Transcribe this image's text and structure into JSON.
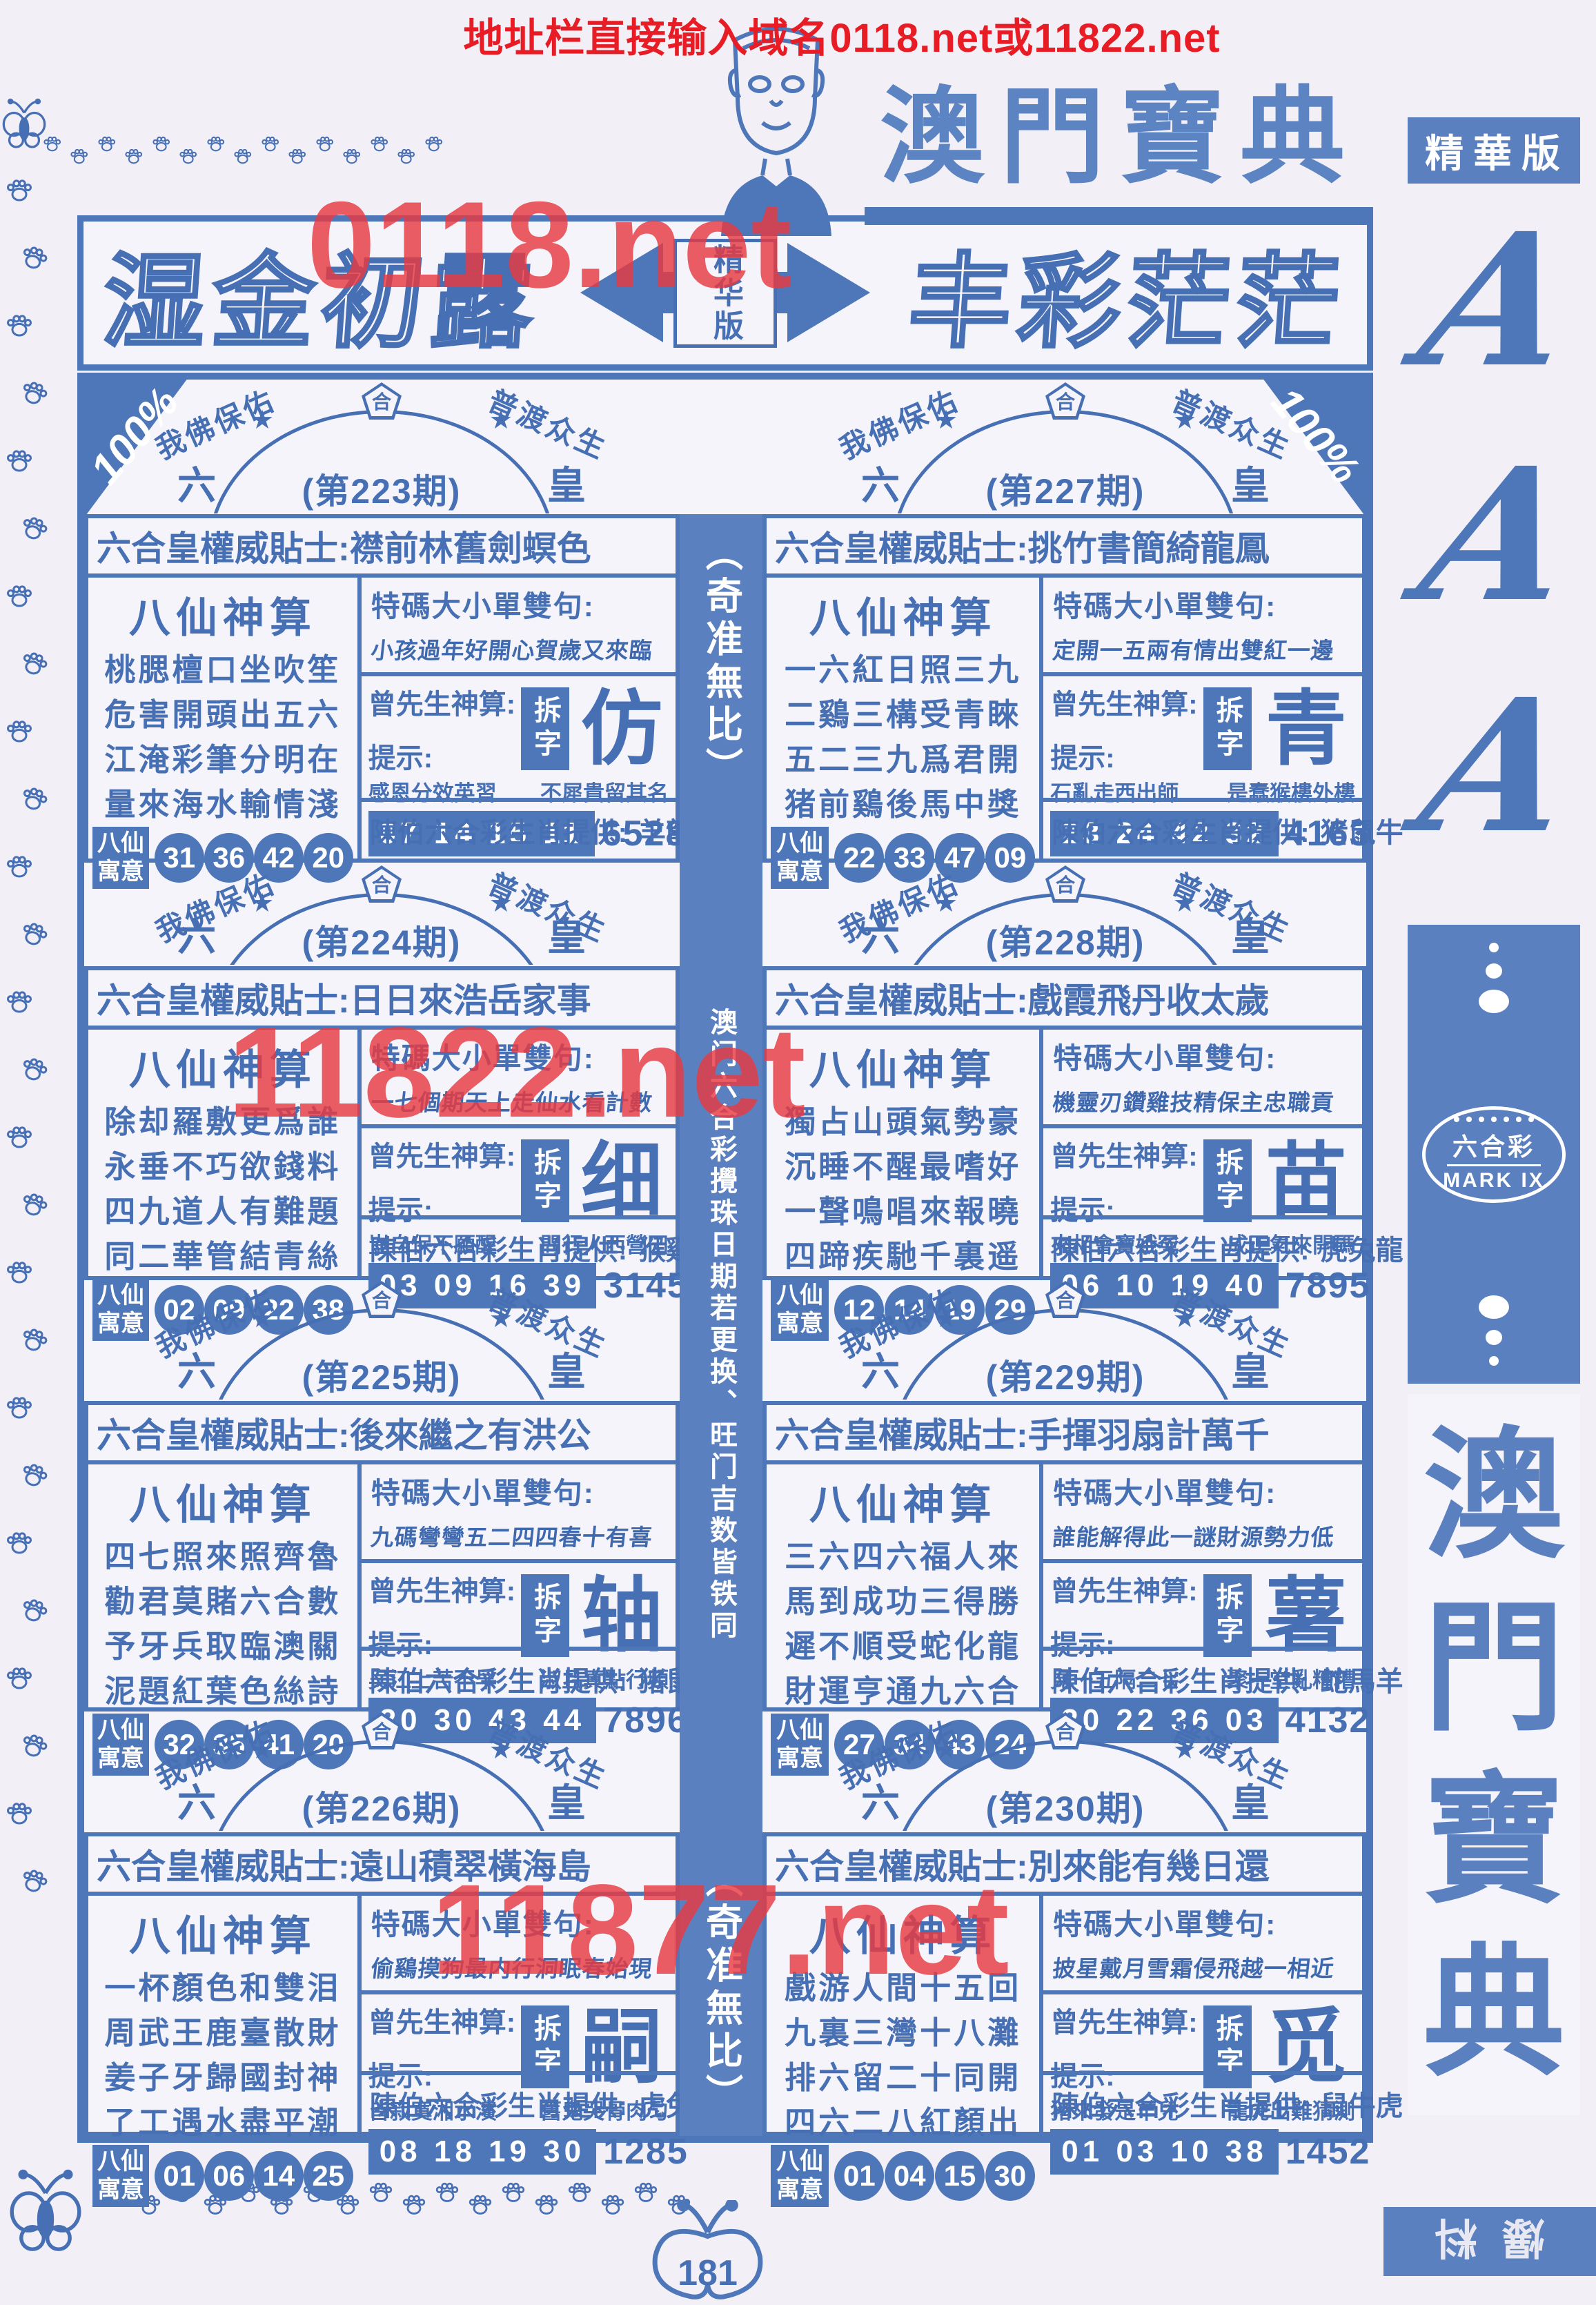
{
  "colors": {
    "ink": "#466fb4",
    "fill": "#4d77b8",
    "sideblue": "#5b80bf",
    "red": "#e83b42",
    "topred": "#e71c24"
  },
  "top": {
    "red_notice": "地址栏直接输入域名0118.net或11822.net",
    "masthead_title": "澳門寶典"
  },
  "watermarks": {
    "top": "0118.net",
    "middle": "11822.net",
    "bottom": "11877.net"
  },
  "banner": {
    "left": "湿金初露",
    "center": "精华版",
    "right": "丰彩茫茫"
  },
  "header": {
    "percent": "100%"
  },
  "arch": {
    "phrase_left": "我佛保佑",
    "phrase_right": "普渡众生",
    "star": "★",
    "crown": "合",
    "left_char": "六",
    "right_char": "皇"
  },
  "center_strip": {
    "top": "（奇准無比）",
    "middle": "澳门六合彩攪珠日期若更换、旺门吉数皆铁同",
    "bottom": "（奇准無比）"
  },
  "panels": [
    {
      "period": "(第223期)",
      "tip_label": "六合皇權威貼士:",
      "tip": "襟前林舊劍螟色",
      "oracle_title": "八仙神算",
      "poem": [
        "桃腮檀口坐吹笙",
        "危害開頭出五六",
        "江淹彩筆分明在",
        "量來海水輸情淺"
      ],
      "special_label": "特碼大小單雙句:",
      "special": "小孩過年好開心賀歲又來臨",
      "master_label": "曾先生神算:",
      "hint_label": "提示:",
      "split_label": "拆字",
      "split_char": "仿",
      "hint_left": "感恩分效英習",
      "hint_right": "不犀貴留其名",
      "numbers": "07 14 15 11",
      "code": "6528",
      "yuyi_label": "八仙寓意",
      "yuyi": [
        "31",
        "36",
        "42",
        "20"
      ],
      "zodiac_label": "陳伯六合彩生肖提供:",
      "zodiac": "羊龍蛇"
    },
    {
      "period": "(第224期)",
      "tip_label": "六合皇權威貼士:",
      "tip": "日日來浩岳家事",
      "oracle_title": "八仙神算",
      "poem": [
        "除却羅敷更爲誰",
        "永垂不巧欲錢料",
        "四九道人有難題",
        "同二華管結青絲"
      ],
      "special_label": "特碼大小單雙句:",
      "special": "一七個期天上走仙水看計數",
      "master_label": "曾先生神算:",
      "hint_label": "提示:",
      "split_label": "拆字",
      "split_char": "细",
      "hint_left": "豈自保不願醒",
      "hint_right": "問行人西營田",
      "numbers": "03 09 16 39",
      "code": "3145",
      "yuyi_label": "八仙寓意",
      "yuyi": [
        "02",
        "09",
        "22",
        "38"
      ],
      "zodiac_label": "陳伯六合彩生肖提供:",
      "zodiac": "猴鷄狗"
    },
    {
      "period": "(第225期)",
      "tip_label": "六合皇權威貼士:",
      "tip": "後來繼之有洪公",
      "oracle_title": "八仙神算",
      "poem": [
        "四七照來照齊魯",
        "勸君莫賭六合數",
        "予牙兵取臨澳關",
        "泥題紅葉色絲詩"
      ],
      "special_label": "特碼大小單雙句:",
      "special": "九碼彎彎五二四四春十有喜",
      "master_label": "曾先生神算:",
      "hint_label": "提示:",
      "split_label": "拆字",
      "split_char": "轴",
      "hint_left": "吴江上苦不早",
      "hint_right": "淑且真點行頻",
      "numbers": "20 30 43 44",
      "code": "7896",
      "yuyi_label": "八仙寓意",
      "yuyi": [
        "32",
        "35",
        "41",
        "20"
      ],
      "zodiac_label": "陳伯六合彩生肖提供:",
      "zodiac": "猪鼠牛"
    },
    {
      "period": "(第226期)",
      "tip_label": "六合皇權威貼士:",
      "tip": "遠山積翠橫海島",
      "oracle_title": "八仙神算",
      "poem": [
        "一杯顏色和雙泪",
        "周武王鹿臺散財",
        "姜子牙歸國封神",
        "了工遇水盡平潮"
      ],
      "special_label": "特碼大小單雙句:",
      "special": "偷鷄摸狗最内行洞眠春始現",
      "master_label": "曾先生神算:",
      "hint_label": "提示:",
      "split_label": "拆字",
      "split_char": "嗣",
      "hint_left": "皆寂寞湘水濱",
      "hint_right": "舊鬼哭骨肉匀",
      "numbers": "08 18 19 30",
      "code": "1285",
      "yuyi_label": "八仙寓意",
      "yuyi": [
        "01",
        "06",
        "14",
        "25"
      ],
      "zodiac_label": "陳伯六合彩生肖提供:",
      "zodiac": "虎兔龍"
    },
    {
      "period": "(第227期)",
      "tip_label": "六合皇權威貼士:",
      "tip": "挑竹書簡綺龍鳳",
      "oracle_title": "八仙神算",
      "poem": [
        "一六紅日照三九",
        "二鷄三構受青睞",
        "五二三九爲君開",
        "猪前鷄後馬中獎"
      ],
      "special_label": "特碼大小單雙句:",
      "special": "定開一五兩有情出雙紅一邊",
      "master_label": "曾先生神算:",
      "hint_label": "提示:",
      "split_label": "拆字",
      "split_char": "青",
      "hint_left": "石亂走西出師",
      "hint_right": "是蠢猴樓外樓",
      "numbers": "23 24 42 32",
      "code": "4163",
      "yuyi_label": "八仙寓意",
      "yuyi": [
        "22",
        "33",
        "47",
        "09"
      ],
      "zodiac_label": "陳伯六合彩生肖提供:",
      "zodiac": "猪鼠牛"
    },
    {
      "period": "(第228期)",
      "tip_label": "六合皇權威貼士:",
      "tip": "戲霞飛丹收太歲",
      "oracle_title": "八仙神算",
      "poem": [
        "獨占山頭氣勢豪",
        "沉睡不醒最嗜好",
        "一聲鳴唱來報曉",
        "四蹄疾馳千裏遥"
      ],
      "special_label": "特碼大小單雙句:",
      "special": "機靈刃鑽雞技精保主忠職貢",
      "master_label": "曾先生神算:",
      "hint_label": "提示:",
      "split_label": "拆字",
      "split_char": "苗",
      "hint_left": "來相會寶娥冤",
      "hint_right": "成正氣來開碼",
      "numbers": "06 10 19 40",
      "code": "7895",
      "yuyi_label": "八仙寓意",
      "yuyi": [
        "12",
        "14",
        "19",
        "29"
      ],
      "zodiac_label": "陳伯六合彩生肖提供:",
      "zodiac": "虎兔龍"
    },
    {
      "period": "(第229期)",
      "tip_label": "六合皇權威貼士:",
      "tip": "手揮羽扇計萬千",
      "oracle_title": "八仙神算",
      "poem": [
        "三六四六福人來",
        "馬到成功三得勝",
        "遲不順受蛇化龍",
        "財運亨通九六合"
      ],
      "special_label": "特碼大小單雙句:",
      "special": "誰能解得此一謎財源勢力低",
      "master_label": "曾先生神算:",
      "hint_label": "提示:",
      "split_label": "拆字",
      "split_char": "薯",
      "hint_left": "見一五隔二七",
      "hint_right": "聚一堂亂糟糟",
      "numbers": "20 22 36 03",
      "code": "4132",
      "yuyi_label": "八仙寓意",
      "yuyi": [
        "27",
        "34",
        "43",
        "24"
      ],
      "zodiac_label": "陳伯六合彩生肖提供:",
      "zodiac": "蛇馬羊"
    },
    {
      "period": "(第230期)",
      "tip_label": "六合皇權威貼士:",
      "tip": "別來能有幾日還",
      "oracle_title": "八仙神算",
      "poem": [
        "戲游人間十五回",
        "九裏三灣十八灘",
        "排六留二十同開",
        "四六二八紅顏出"
      ],
      "special_label": "特碼大小單雙句:",
      "special": "披星戴月雪霜侵飛越一相近",
      "master_label": "曾先生神算:",
      "hint_label": "提示:",
      "split_label": "拆字",
      "split_char": "觅",
      "hint_left": "猪來發是羊兒",
      "hint_right": "龍虎出難猜測",
      "numbers": "01 03 10 38",
      "code": "1452",
      "yuyi_label": "八仙寓意",
      "yuyi": [
        "01",
        "04",
        "15",
        "30"
      ],
      "zodiac_label": "陳伯六合彩生肖提供:",
      "zodiac": "鼠牛虎"
    }
  ],
  "sidebar": {
    "edition": "精華版",
    "aaa": [
      "A",
      "A",
      "A"
    ],
    "logo_cn": "六合彩",
    "logo_en": "MARK IX",
    "book": [
      "澳",
      "門",
      "寶",
      "典"
    ],
    "footer": "爆料"
  },
  "footer": {
    "page": "181"
  }
}
